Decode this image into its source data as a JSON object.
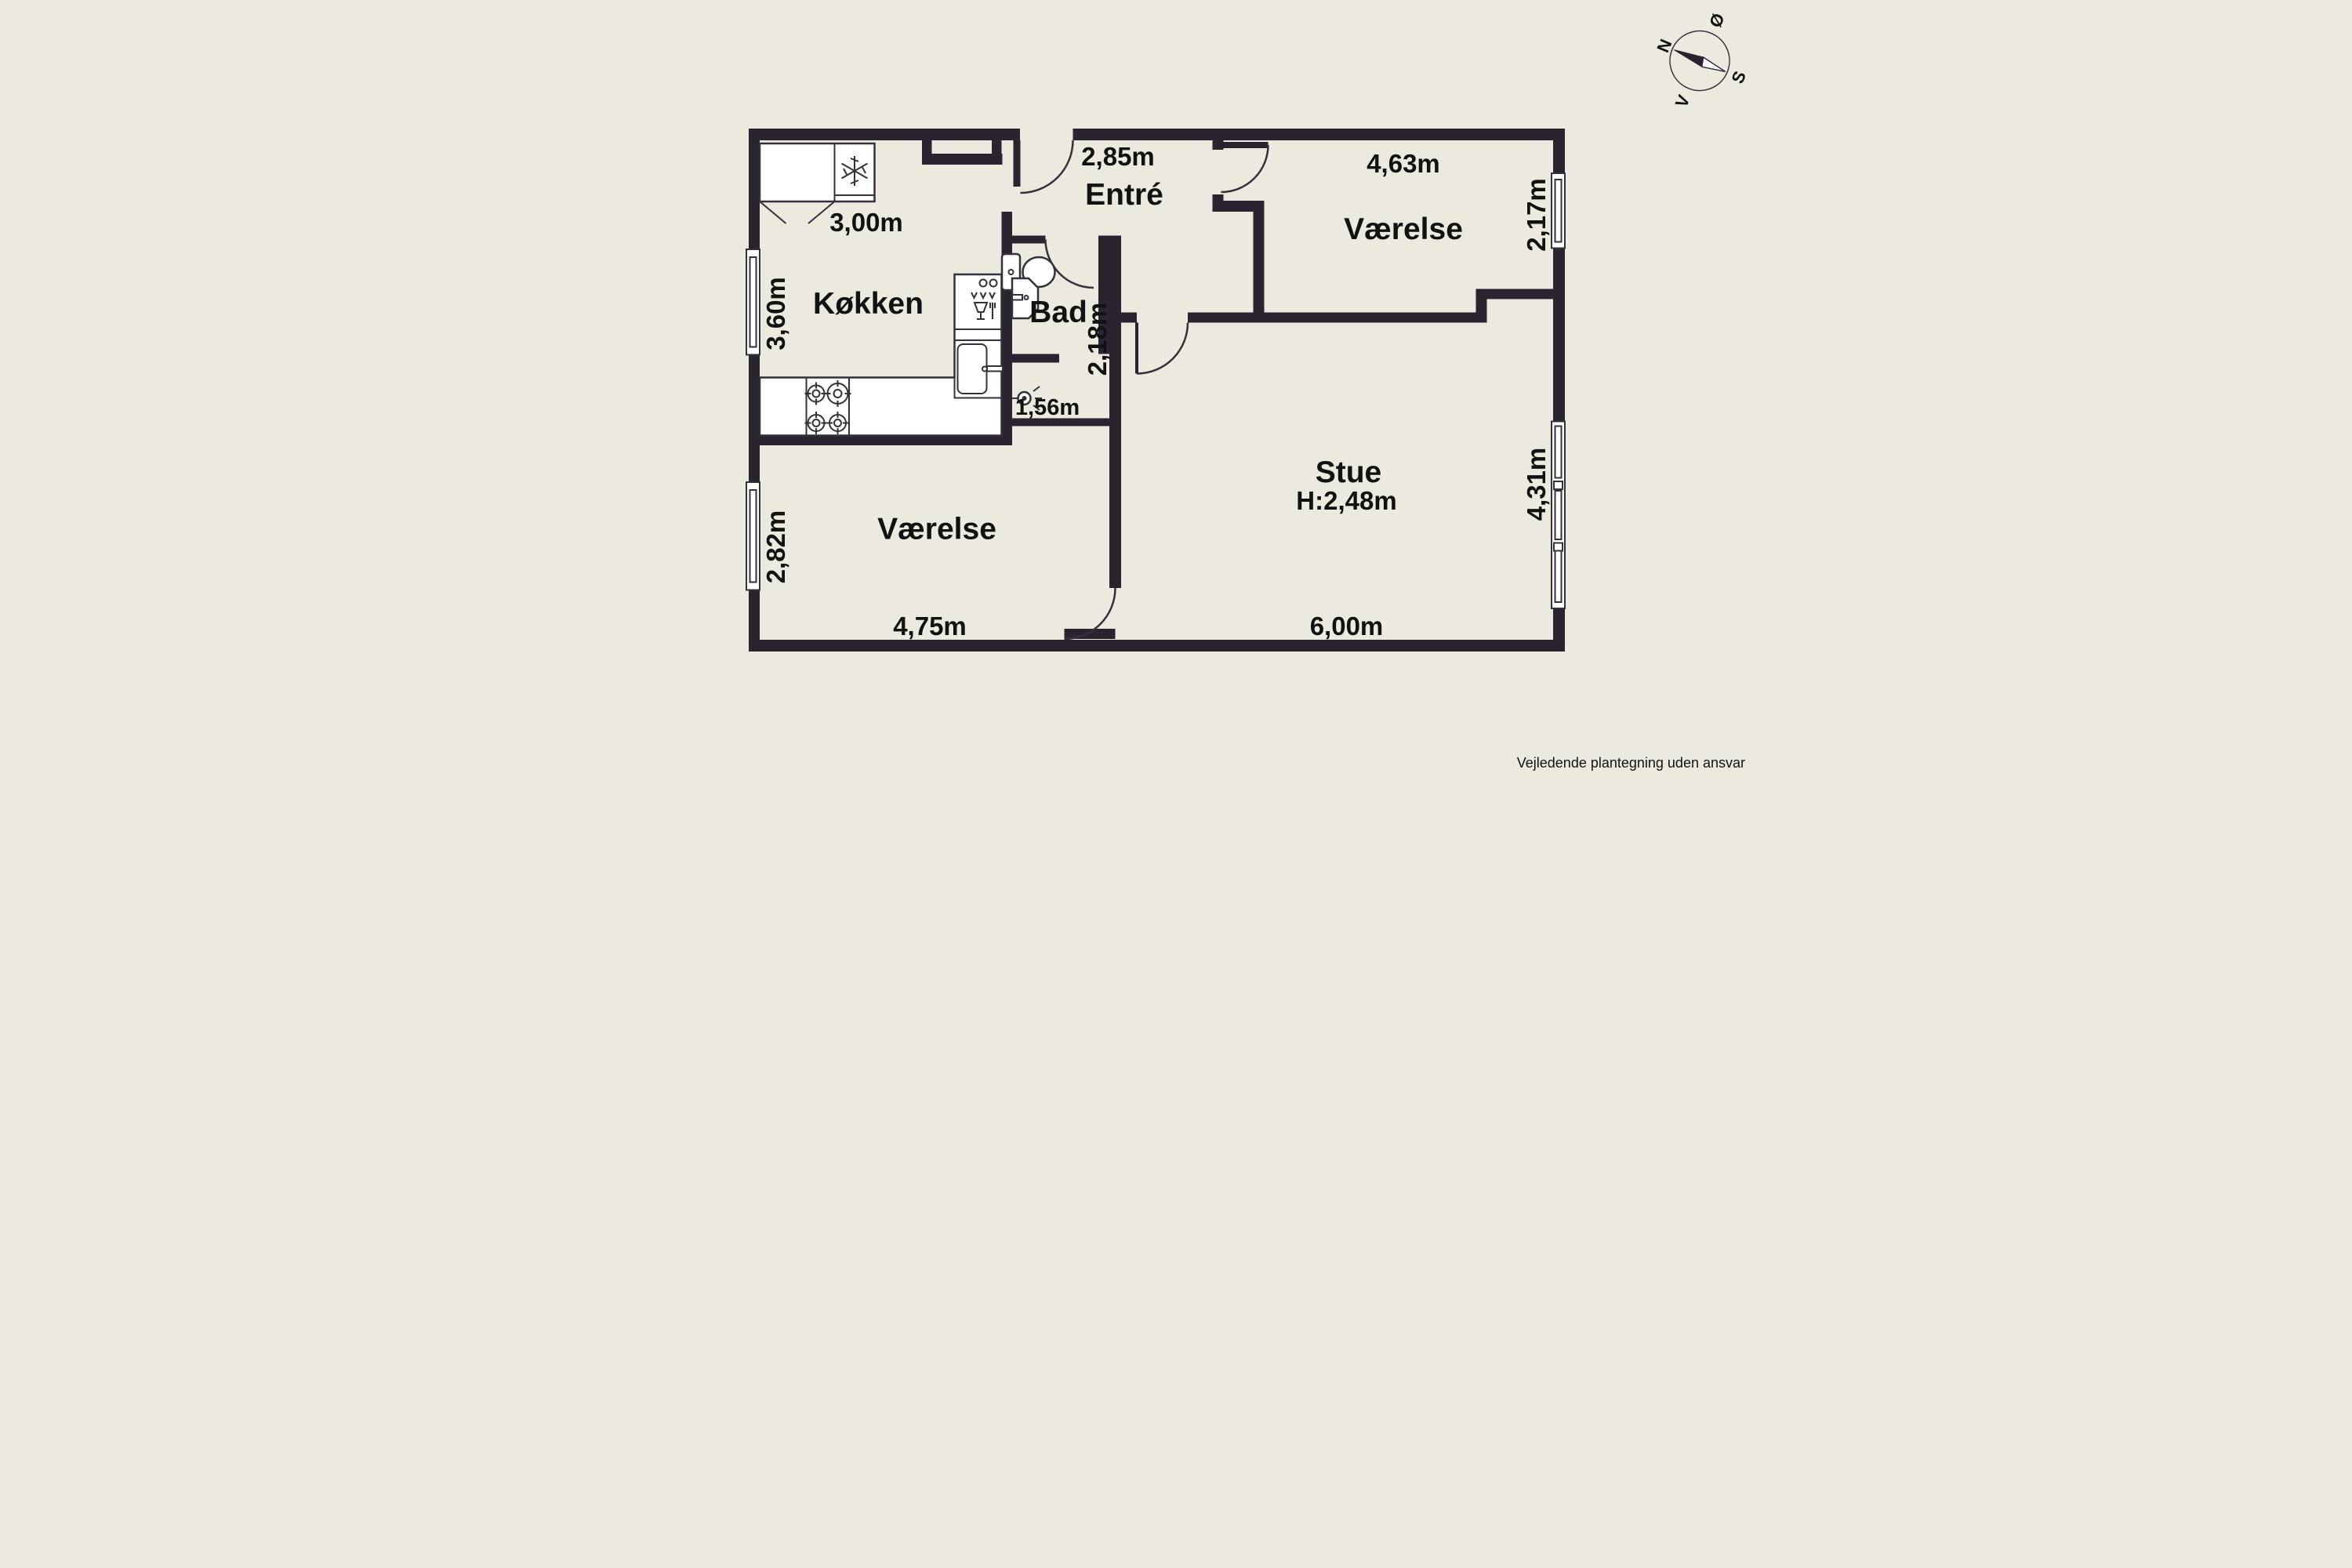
{
  "floorplan": {
    "footer": "Vejledende plantegning uden ansvar",
    "compass": {
      "north": "N",
      "east": "Ø",
      "south": "S",
      "west": "V"
    },
    "rooms": [
      {
        "id": "koekken",
        "name": "Køkken",
        "dim_top": "3,00m",
        "dim_left": "3,60m"
      },
      {
        "id": "entre",
        "name": "Entré",
        "dim_top": "2,85m"
      },
      {
        "id": "bad",
        "name": "Bad",
        "dim_right": "2,18m",
        "dim_alcove": "1,56m"
      },
      {
        "id": "vaerelse_ne",
        "name": "Værelse",
        "dim_top": "4,63m",
        "dim_right": "2,17m"
      },
      {
        "id": "stue",
        "name": "Stue",
        "ceiling": "H:2,48m",
        "dim_bottom": "6,00m",
        "dim_right": "4,31m"
      },
      {
        "id": "vaerelse_sw",
        "name": "Værelse",
        "dim_bottom": "4,75m",
        "dim_left": "2,82m"
      }
    ],
    "colors": {
      "wall": "#2a2430",
      "bg": "#eceade",
      "line": "#35313c",
      "text": "#121212"
    }
  }
}
